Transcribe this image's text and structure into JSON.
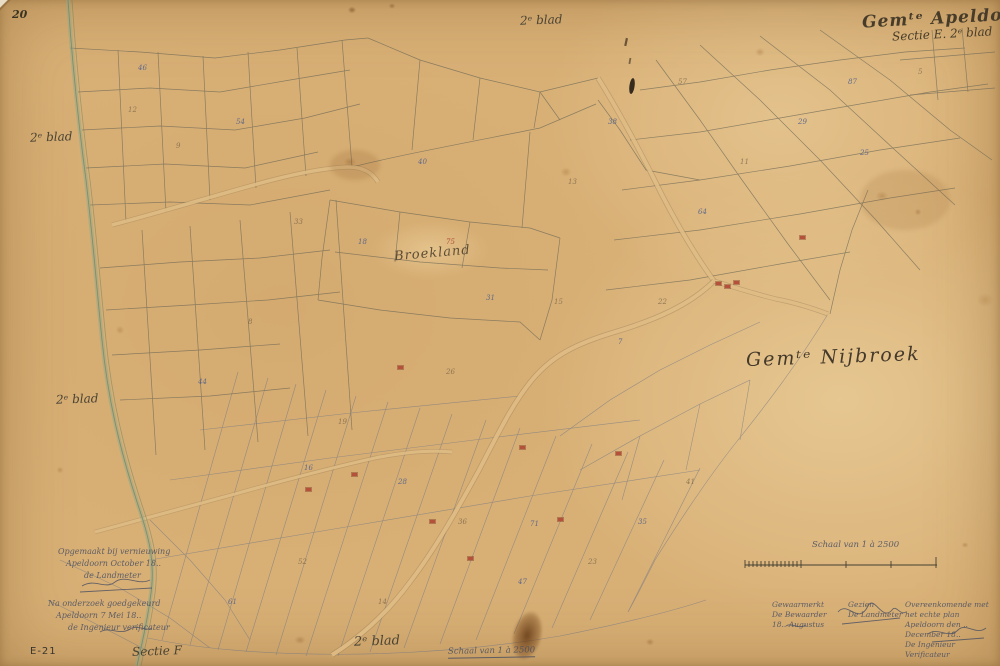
{
  "sheet": {
    "page_number": "20",
    "archive_code": "E-21",
    "title": {
      "line1": "Gemᵗᵉ Apeldoorn",
      "line2": "Sectie E. 2ᵉ blad"
    },
    "labels": {
      "municipality": "Gemᵗᵉ Nijbroek",
      "locality": "Broekland",
      "adjacent_section": "Sectie F",
      "edge_top": "2ᵉ blad",
      "edge_left_upper": "2ᵉ blad",
      "edge_left_lower": "2ᵉ blad",
      "edge_bottom": "2ᵉ blad"
    },
    "scale": {
      "caption_right": "Schaal van 1 à 2500",
      "caption_bottom": "Schaal van 1 à 2500"
    },
    "certifications": {
      "left_block1": {
        "line1": "Opgemaakt bij vernieuwing",
        "line2": "Apeldoorn October 18..",
        "line3": "de Landmeter"
      },
      "left_block2": {
        "line1": "Na onderzoek goedgekeurd",
        "line2": "Apeldoorn 7 Mei 18..",
        "line3": "de Ingenieur verificateur"
      },
      "right_col1": {
        "line1": "Gewaarmerkt",
        "line2": "De Bewaarder",
        "line3": "18.. Augustus"
      },
      "right_col2": {
        "line1": "Gezien",
        "line2": "De Landmeter"
      },
      "right_col3": {
        "line1": "Overeenkomende met het echte plan",
        "line2": "Apeldoorn den .. December 18..",
        "line3": "De Ingenieur Verificateur"
      }
    }
  },
  "colors": {
    "paper": "#d8b076",
    "ink": "#3a3322",
    "blue_ink": "#4a5c8c",
    "parcel_line": "#6d6856",
    "stream": "#7fa183",
    "road_fill": "#e2bf86",
    "building": "#b5503a"
  },
  "parcel_numbers": [
    {
      "t": "46",
      "x": 138,
      "y": 64
    },
    {
      "t": "12",
      "x": 128,
      "y": 106,
      "c": "s"
    },
    {
      "t": "54",
      "x": 236,
      "y": 118
    },
    {
      "t": "9",
      "x": 176,
      "y": 142,
      "c": "s"
    },
    {
      "t": "40",
      "x": 418,
      "y": 158
    },
    {
      "t": "13",
      "x": 568,
      "y": 178,
      "c": "s"
    },
    {
      "t": "38",
      "x": 608,
      "y": 118
    },
    {
      "t": "57",
      "x": 678,
      "y": 78,
      "c": "s"
    },
    {
      "t": "87",
      "x": 848,
      "y": 78
    },
    {
      "t": "5",
      "x": 918,
      "y": 68,
      "c": "s"
    },
    {
      "t": "29",
      "x": 798,
      "y": 118
    },
    {
      "t": "11",
      "x": 740,
      "y": 158,
      "c": "s"
    },
    {
      "t": "64",
      "x": 698,
      "y": 208
    },
    {
      "t": "25",
      "x": 860,
      "y": 149
    },
    {
      "t": "22",
      "x": 658,
      "y": 298,
      "c": "s"
    },
    {
      "t": "7",
      "x": 618,
      "y": 338
    },
    {
      "t": "33",
      "x": 294,
      "y": 218,
      "c": "s"
    },
    {
      "t": "18",
      "x": 358,
      "y": 238
    },
    {
      "t": "31",
      "x": 486,
      "y": 294
    },
    {
      "t": "15",
      "x": 554,
      "y": 298,
      "c": "s"
    },
    {
      "t": "75",
      "x": 446,
      "y": 238,
      "c": "r"
    },
    {
      "t": "8",
      "x": 248,
      "y": 318,
      "c": "s"
    },
    {
      "t": "44",
      "x": 198,
      "y": 378
    },
    {
      "t": "26",
      "x": 446,
      "y": 368,
      "c": "s"
    },
    {
      "t": "16",
      "x": 304,
      "y": 464
    },
    {
      "t": "19",
      "x": 338,
      "y": 418,
      "c": "s"
    },
    {
      "t": "28",
      "x": 398,
      "y": 478
    },
    {
      "t": "36",
      "x": 458,
      "y": 518,
      "c": "s"
    },
    {
      "t": "71",
      "x": 530,
      "y": 520
    },
    {
      "t": "52",
      "x": 298,
      "y": 558,
      "c": "s"
    },
    {
      "t": "61",
      "x": 228,
      "y": 598
    },
    {
      "t": "14",
      "x": 378,
      "y": 598,
      "c": "s"
    },
    {
      "t": "47",
      "x": 518,
      "y": 578
    },
    {
      "t": "23",
      "x": 588,
      "y": 558,
      "c": "s"
    },
    {
      "t": "35",
      "x": 638,
      "y": 518
    },
    {
      "t": "41",
      "x": 686,
      "y": 478,
      "c": "s"
    }
  ],
  "building_marks": [
    {
      "x": 716,
      "y": 282
    },
    {
      "x": 725,
      "y": 285
    },
    {
      "x": 734,
      "y": 281
    },
    {
      "x": 398,
      "y": 366
    },
    {
      "x": 520,
      "y": 446
    },
    {
      "x": 558,
      "y": 518
    },
    {
      "x": 616,
      "y": 452
    },
    {
      "x": 800,
      "y": 236
    },
    {
      "x": 306,
      "y": 488
    },
    {
      "x": 352,
      "y": 473
    },
    {
      "x": 468,
      "y": 557
    },
    {
      "x": 430,
      "y": 520
    }
  ]
}
